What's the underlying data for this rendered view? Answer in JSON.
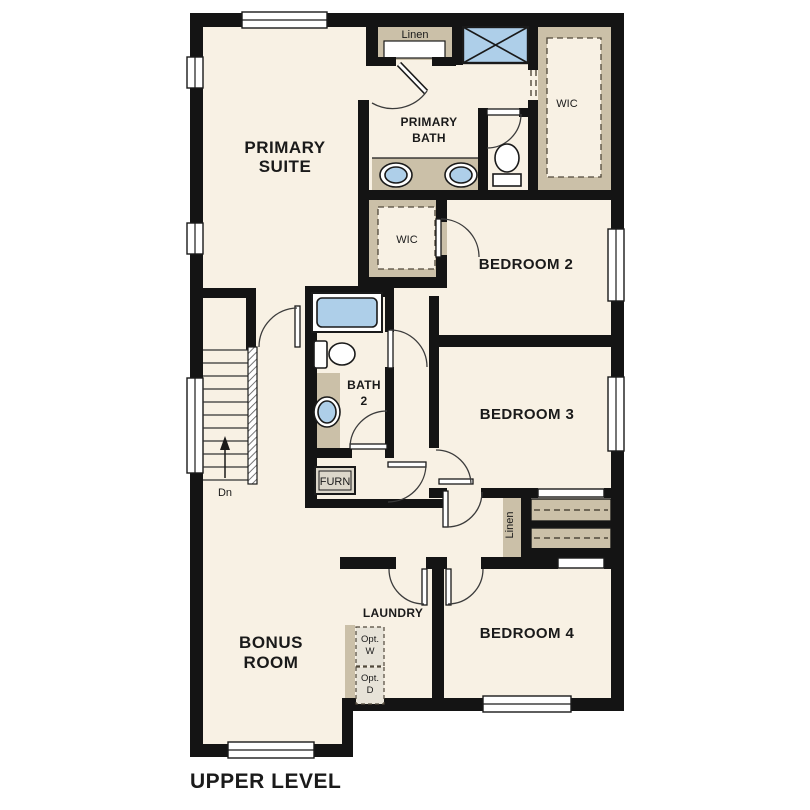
{
  "title": "UPPER LEVEL",
  "colors": {
    "wall": "#141414",
    "floor": "#f8f1e4",
    "casework_tan": "#cbc0a8",
    "fixture_blue": "#aecfe9",
    "background": "#ffffff"
  },
  "rooms": {
    "primary_suite": {
      "line1": "PRIMARY",
      "line2": "SUITE"
    },
    "primary_bath": {
      "line1": "PRIMARY",
      "line2": "BATH"
    },
    "wic_primary": {
      "label": "WIC"
    },
    "wic_bedroom2": {
      "label": "WIC"
    },
    "linen_top": {
      "label": "Linen"
    },
    "linen_hall": {
      "label": "Linen"
    },
    "bedroom2": {
      "label": "BEDROOM 2"
    },
    "bedroom3": {
      "label": "BEDROOM 3"
    },
    "bedroom4": {
      "label": "BEDROOM 4"
    },
    "bath2": {
      "line1": "BATH",
      "line2": "2"
    },
    "bonus_room": {
      "line1": "BONUS",
      "line2": "ROOM"
    },
    "laundry": {
      "label": "LAUNDRY"
    },
    "furnace": {
      "label": "FURN"
    },
    "stairs": {
      "direction_label": "Dn"
    },
    "opt_washer": {
      "line1": "Opt.",
      "line2": "W"
    },
    "opt_dryer": {
      "line1": "Opt.",
      "line2": "D"
    }
  }
}
